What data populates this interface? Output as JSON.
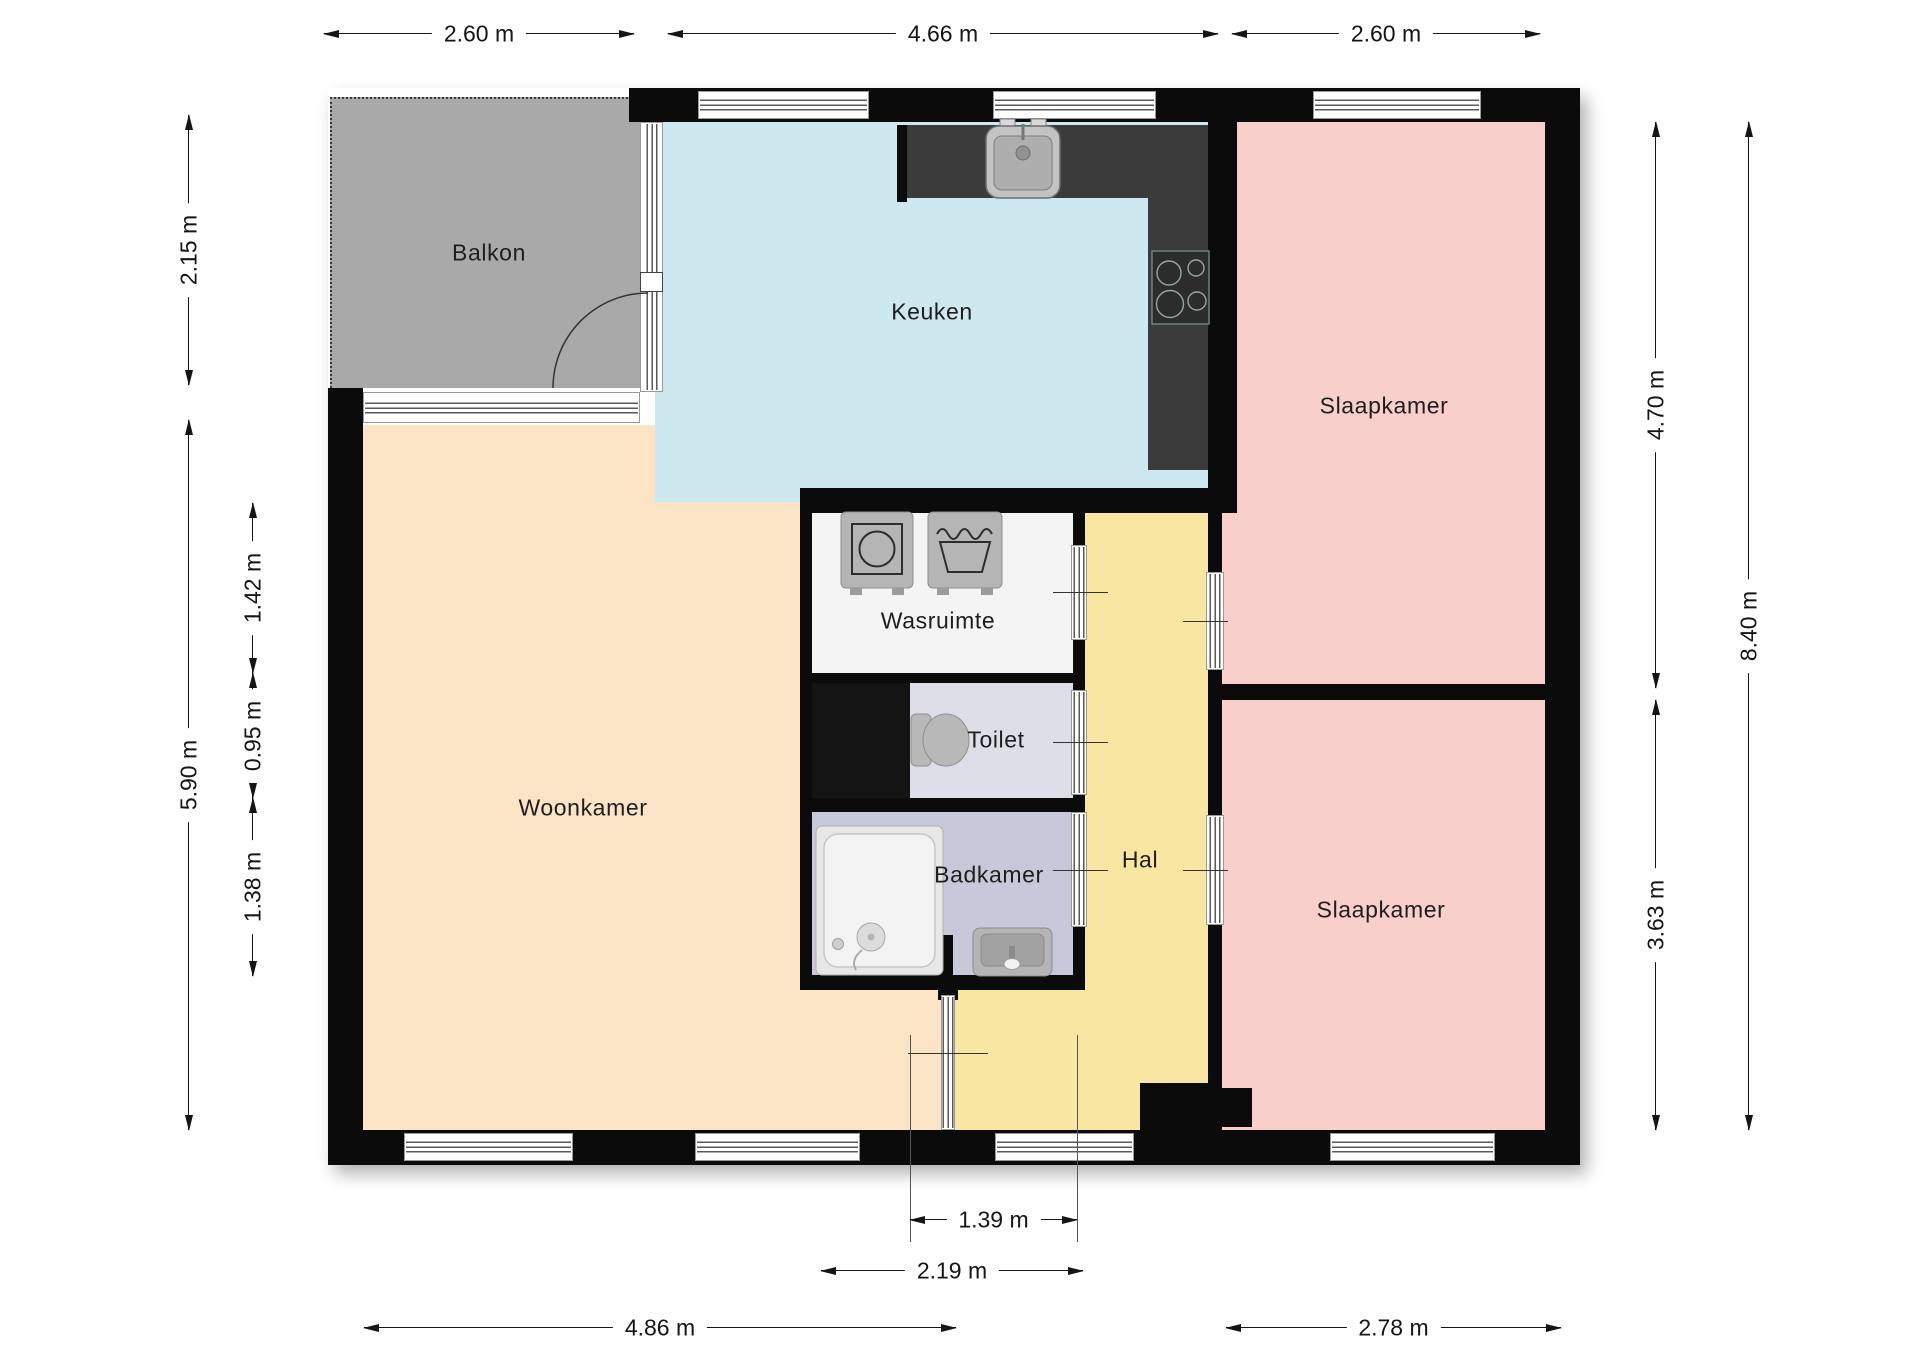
{
  "plan_title": "Floor plan (apartment)",
  "rooms": {
    "balkon": {
      "label": "Balkon",
      "color": "#a9a9a9"
    },
    "keuken": {
      "label": "Keuken",
      "color": "#cde8ee"
    },
    "slaapkamer_boven": {
      "label": "Slaapkamer",
      "color": "#f8cfcb"
    },
    "slaapkamer_onder": {
      "label": "Slaapkamer",
      "color": "#f8cfcb"
    },
    "woonkamer": {
      "label": "Woonkamer",
      "color": "#fbe3c5"
    },
    "wasruimte": {
      "label": "Wasruimte",
      "color": "#f4f4f4"
    },
    "toilet": {
      "label": "Toilet",
      "color": "#dedee9"
    },
    "badkamer": {
      "label": "Badkamer",
      "color": "#c8c8db"
    },
    "hal": {
      "label": "Hal",
      "color": "#f8e6a2"
    }
  },
  "dimensions": {
    "top": [
      {
        "label": "2.60 m"
      },
      {
        "label": "4.66 m"
      },
      {
        "label": "2.60 m"
      }
    ],
    "left_outer": [
      {
        "label": "2.15 m"
      },
      {
        "label": "5.90 m"
      }
    ],
    "left_inner": [
      {
        "label": "1.42 m"
      },
      {
        "label": "0.95 m"
      },
      {
        "label": "1.38 m"
      }
    ],
    "right_inner": [
      {
        "label": "4.70 m"
      },
      {
        "label": "3.63 m"
      }
    ],
    "right_outer": [
      {
        "label": "8.40 m"
      }
    ],
    "bottom": [
      {
        "label": "1.39 m"
      },
      {
        "label": "2.19 m"
      },
      {
        "label": "4.86 m"
      },
      {
        "label": "2.78 m"
      }
    ]
  },
  "palette": {
    "wall": "#0b0b0b",
    "kitchen_counter": "#3b3b3b",
    "fixture_gray": "#b5b5b5",
    "shaft_black": "#141414",
    "dim_line": "#151515",
    "background": "#ffffff"
  },
  "fixtures": [
    "balcony-door",
    "kitchen-sink",
    "cooktop",
    "washing-machine",
    "handwash-basin",
    "toilet",
    "bathtub",
    "washbasin",
    "front-door",
    "glass-partition"
  ]
}
